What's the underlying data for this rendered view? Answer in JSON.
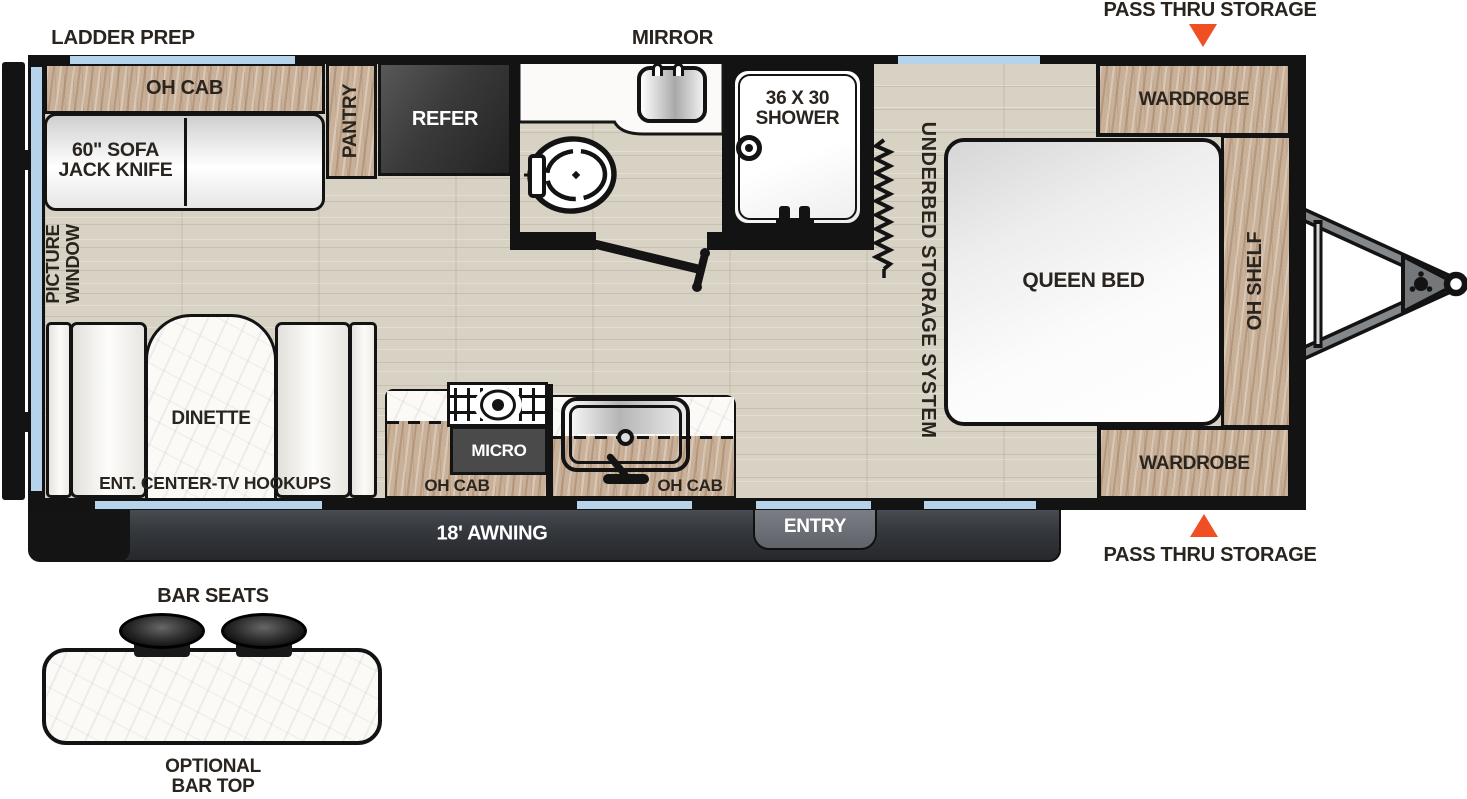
{
  "exterior": {
    "ladder_prep": "LADDER PREP",
    "mirror": "MIRROR",
    "pass_thru_storage_top": "PASS THRU STORAGE",
    "pass_thru_storage_bottom": "PASS THRU STORAGE",
    "awning": "18' AWNING",
    "entry": "ENTRY"
  },
  "living": {
    "oh_cab": "OH CAB",
    "sofa_line1": "60\" SOFA",
    "sofa_line2": "JACK KNIFE",
    "picture_window_line1": "PICTURE",
    "picture_window_line2": "WINDOW",
    "dinette": "DINETTE",
    "ent_center_tv": "ENT. CENTER-TV HOOKUPS"
  },
  "kitchen": {
    "pantry": "PANTRY",
    "refer": "REFER",
    "micro": "MICRO",
    "oh_cab_left": "OH CAB",
    "oh_cab_right": "OH CAB"
  },
  "bathroom": {
    "shower_size": "36 X 30",
    "shower": "SHOWER"
  },
  "bedroom": {
    "queen_bed": "QUEEN BED",
    "underbed_storage": "UNDERBED STORAGE SYSTEM",
    "wardrobe_top": "WARDROBE",
    "wardrobe_bottom": "WARDROBE",
    "oh_shelf": "OH SHELF"
  },
  "bar": {
    "seats": "BAR SEATS",
    "optional_line1": "OPTIONAL",
    "optional_line2": "BAR TOP"
  },
  "colors": {
    "wall": "#131313",
    "floor_wood": "#d8d2c4",
    "cabinet_wood": "#c9b199",
    "window_blue": "#b5d3ea",
    "awning_gray": "#33363b",
    "arrow_orange": "#f04e23",
    "appliance_dark": "#3a3a3a",
    "label_dark": "#2a241f"
  }
}
